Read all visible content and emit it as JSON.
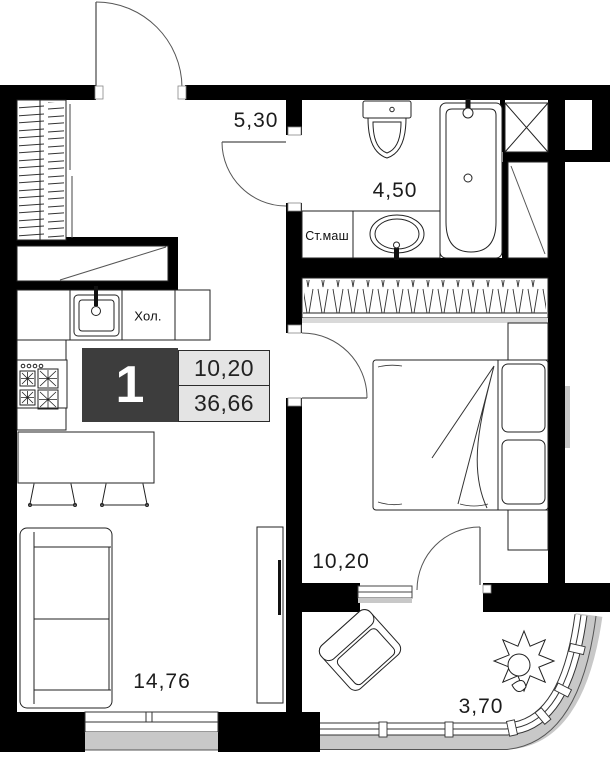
{
  "badge": {
    "rooms": "1",
    "area_living": "10,20",
    "area_total": "36,66"
  },
  "rooms": {
    "hall": {
      "area": "5,30"
    },
    "bathroom": {
      "area": "4,50"
    },
    "bedroom": {
      "area": "10,20"
    },
    "living": {
      "area": "14,76"
    },
    "balcony": {
      "area": "3,70"
    }
  },
  "labels": {
    "washing_machine": "Ст.маш",
    "fridge": "Хол."
  },
  "colors": {
    "wall": "#000000",
    "badge_dark": "#3d3d3d",
    "badge_light": "#e4e4e4",
    "glazing_gray": "#c8c8c8",
    "line": "#222222"
  }
}
